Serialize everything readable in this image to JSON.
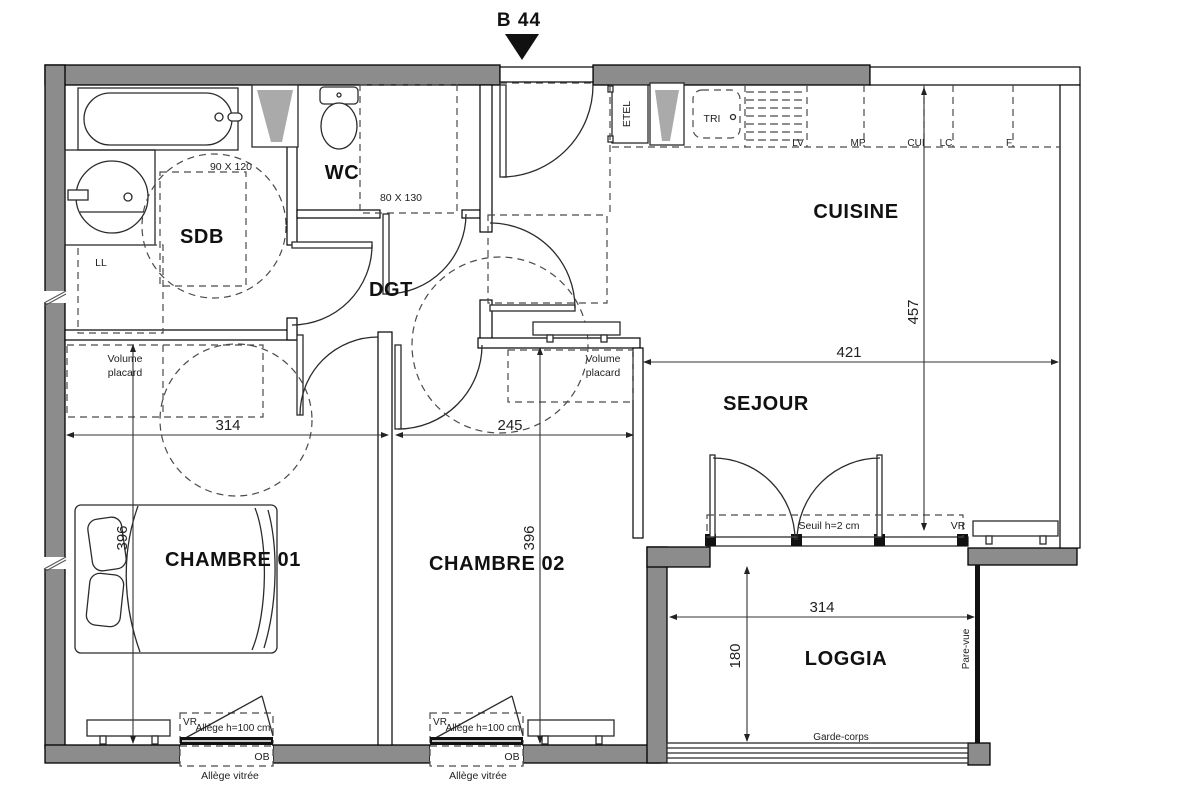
{
  "title": {
    "label": "B 44"
  },
  "rooms": {
    "sdb": "SDB",
    "wc": "WC",
    "dgt": "DGT",
    "cuisine": "CUISINE",
    "sejour": "SEJOUR",
    "chambre1": "CHAMBRE 01",
    "chambre2": "CHAMBRE 02",
    "loggia": "LOGGIA"
  },
  "fixtures": {
    "etel": "ETEL",
    "tri": "TRI",
    "lv": "LV",
    "mp": "MP",
    "cui": "CUI",
    "lc": "LC",
    "f": "F",
    "ll": "LL"
  },
  "annotations": {
    "sdb_clearance": "90 X 120",
    "wc_clearance": "80 X 130",
    "volume_placard_line1": "Volume",
    "volume_placard_line2": "placard",
    "seuil": "Seuil h=2 cm",
    "vr": "VR",
    "allege": "Allège h=100 cm",
    "ob": "OB",
    "allege_vitree": "Allège vitrée",
    "garde_corps": "Garde-corps",
    "pare_vue": "Pare-vue"
  },
  "dimensions": {
    "chambre1_width": "314",
    "chambre2_width": "245",
    "chambre1_depth": "396",
    "chambre2_depth": "396",
    "sejour_width": "421",
    "cuisine_depth": "457",
    "loggia_width": "314",
    "loggia_depth": "180"
  },
  "colors": {
    "wall_gray": "#8c8c8c",
    "line": "#1a1a1a"
  }
}
